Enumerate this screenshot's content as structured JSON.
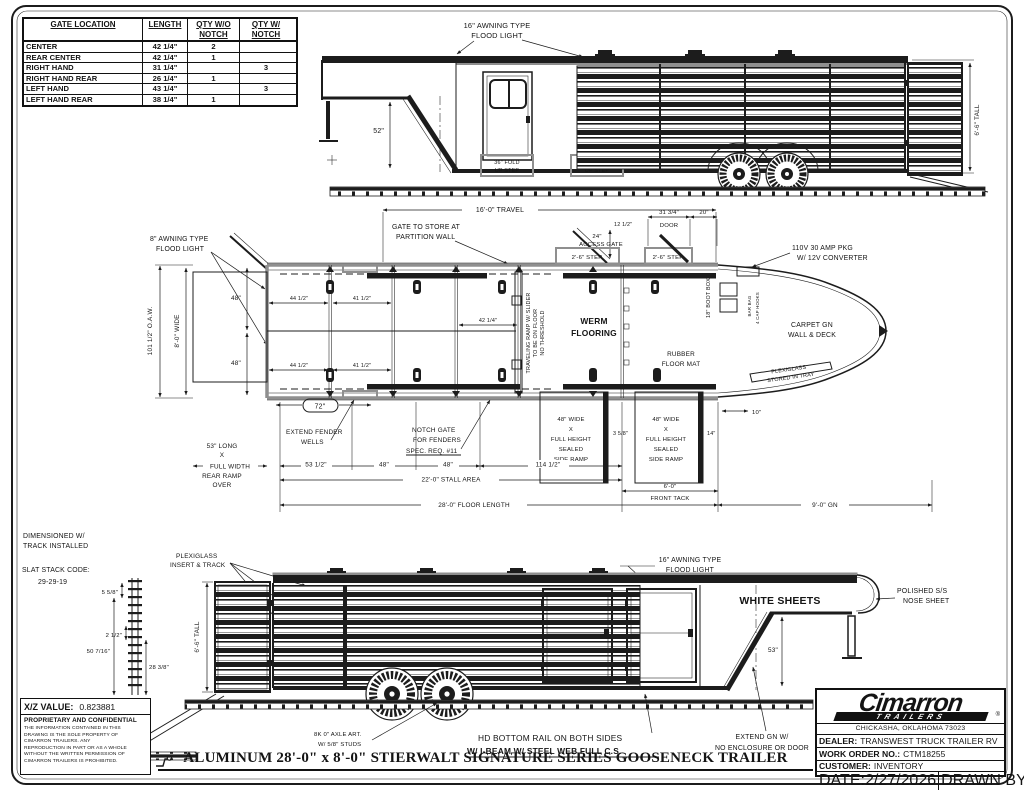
{
  "table": {
    "headers": [
      "GATE LOCATION",
      "LENGTH",
      "QTY W/O NOTCH",
      "QTY W/ NOTCH"
    ],
    "rows": [
      {
        "loc": "CENTER",
        "len": "42 1/4\"",
        "wo": "2",
        "w": ""
      },
      {
        "loc": "REAR CENTER",
        "len": "42 1/4\"",
        "wo": "1",
        "w": ""
      },
      {
        "loc": "RIGHT HAND",
        "len": "31 1/4\"",
        "wo": "",
        "w": "3"
      },
      {
        "loc": "RIGHT HAND REAR",
        "len": "26 1/4\"",
        "wo": "1",
        "w": ""
      },
      {
        "loc": "LEFT HAND",
        "len": "43 1/4\"",
        "wo": "",
        "w": "3"
      },
      {
        "loc": "LEFT HAND REAR",
        "len": "38 1/4\"",
        "wo": "1",
        "w": ""
      }
    ]
  },
  "top": {
    "flood": [
      "16\" AWNING TYPE",
      "FLOOD LIGHT"
    ],
    "dim52": "52\"",
    "step": [
      "36\" FOLD",
      "UP STEP"
    ],
    "tall": "6'-6\" TALL"
  },
  "plan": {
    "travel": "16'-0\" TRAVEL",
    "gate_store": [
      "GATE TO STORE AT",
      "PARTITION WALL"
    ],
    "flood8": [
      "8\" AWNING TYPE",
      "FLOOD LIGHT"
    ],
    "oaw": "101 1/2\" O.A.W.",
    "wide": "8'-0\" WIDE",
    "d48": "48\"",
    "d24": "24\"",
    "access": "ACCESS GATE",
    "d12": "12 1/2\"",
    "step": "2'-6\" STEP",
    "d31": "31 3/4\"",
    "door": "DOOR",
    "d20": "20\"",
    "pkg": [
      "110V 30 AMP PKG",
      "W/ 12V CONVERTER"
    ],
    "boot": "18\" BOOT BOX",
    "bar_bag": "BAR BAG",
    "cap_hooks": "4 CAP HOOKS",
    "carpet": [
      "CARPET GN",
      "WALL & DECK"
    ],
    "werm": [
      "WERM",
      "FLOORING"
    ],
    "rubber": [
      "RUBBER",
      "FLOOR MAT"
    ],
    "plexi_tray": [
      "PLEXIGLASS",
      "STORED IN TRAY"
    ],
    "ramp_note": [
      "TRAVELING RAMP W/ SLIDER",
      "TO BE ON FLOOR",
      "NO THRESHOLD"
    ],
    "extend_fender": [
      "EXTEND FENDER",
      "WELLS"
    ],
    "notch": [
      "NOTCH GATE",
      "FOR FENDERS",
      "SPEC. REQ. #11"
    ],
    "d72": "72\"",
    "rear_ramp": [
      "53\" LONG",
      "X",
      "FULL WIDTH",
      "REAR RAMP",
      "OVER"
    ],
    "d53h": "53 1/2\"",
    "d114": "114 1/2\"",
    "stall": "22'-0\" STALL AREA",
    "floor": "28'-0\" FLOOR LENGTH",
    "ramp": [
      "48\" WIDE",
      "X",
      "FULL HEIGHT",
      "SEALED",
      "SIDE RAMP"
    ],
    "d358": "3 5/8\"",
    "d14": "14\"",
    "d10": "10\"",
    "tack1": "6'-0\"",
    "tack2": "FRONT TACK",
    "gn": "9'-0\" GN",
    "d44": "44 1/2\"",
    "d41": "41 1/2\"",
    "d42": "42 1/4\""
  },
  "bottom": {
    "dimtrack": [
      "DIMENSIONED W/",
      "TRACK INSTALLED"
    ],
    "slat_label": "SLAT STACK CODE:",
    "slat_code": "29-29-19",
    "sdim": [
      "5 5/8\"",
      "2 1/2\"",
      "50 7/16\"",
      "28 3/8\""
    ],
    "plexi": [
      "PLEXIGLASS",
      "INSERT & TRACK"
    ],
    "flood": [
      "16\" AWNING TYPE",
      "FLOOD LIGHT"
    ],
    "white_sheets": "WHITE SHEETS",
    "nose": [
      "POLISHED S/S",
      "NOSE SHEET"
    ],
    "d53": "53\"",
    "tall": "6'-6\" TALL",
    "axle": [
      "8K 0\" AXLE ART.",
      "W/ 5/8\" STUDS"
    ],
    "rail": "HD BOTTOM RAIL ON BOTH SIDES",
    "ibeam": "W/ I-BEAM W/ STEEL WEB FULL C.S.",
    "extend_gn": [
      "EXTEND GN W/",
      "NO ENCLOSURE OR DOOR"
    ]
  },
  "titleblock": {
    "brand": "Cimarron",
    "brand_sub": "TRAILERS",
    "reg": "®",
    "city": "CHICKASHA, OKLAHOMA 73023",
    "dealer_label": "DEALER:",
    "dealer": "TRANSWEST TRUCK TRAILER RV",
    "wo_label": "WORK ORDER NO.:",
    "wo": "CTM18255",
    "customer_label": "CUSTOMER:",
    "customer": "INVENTORY",
    "date_label": "DATE:",
    "date": "2/27/2026",
    "drawn_label": "DRAWN BY:",
    "drawn": "AJ"
  },
  "legal": {
    "xz_label": "X/Z VALUE:",
    "xz_value": "0.823881",
    "prop_title": "PROPRIETARY AND CONFIDENTIAL",
    "prop_lines": [
      "THE INFORMATION CONTAINED IN THIS",
      "DRAWING IS THE SOLE PROPERTY OF",
      "CIMARRON TRAILERS. ANY",
      "REPRODUCTION IN PART OR AS A WHOLE",
      "WITHOUT THE WRITTEN PERMISSION OF",
      "CIMARRON TRAILERS IS PROHIBITED."
    ]
  },
  "title": "ALUMINUM 28'-0\" x 8'-0\" STIERWALT SIGNATURE SERIES GOOSENECK TRAILER"
}
